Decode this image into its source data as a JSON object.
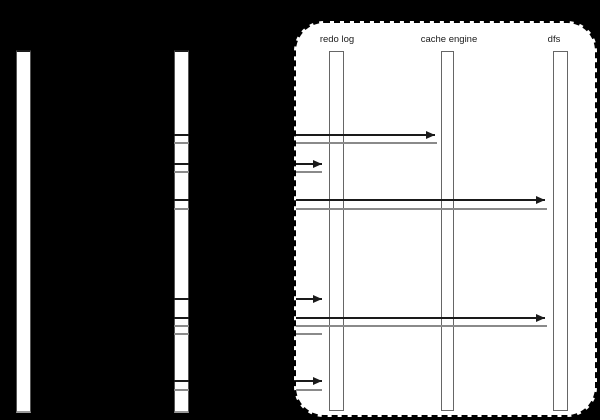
{
  "diagram": {
    "type": "sequence",
    "unlabeled_activation_bars": 2,
    "lifelines": [
      {
        "label": "redo log"
      },
      {
        "label": "cache engine"
      },
      {
        "label": "dfs"
      }
    ],
    "messages": [
      {
        "kind": "call",
        "target": "cache engine",
        "y": 135,
        "x_end": 435
      },
      {
        "kind": "return",
        "y": 143,
        "x_end": 437
      },
      {
        "kind": "call",
        "target": "redo log",
        "y": 164,
        "x_end": 322
      },
      {
        "kind": "return",
        "y": 172,
        "x_end": 322
      },
      {
        "kind": "call",
        "target": "dfs",
        "y": 200,
        "x_end": 545
      },
      {
        "kind": "return",
        "y": 209,
        "x_end": 547
      },
      {
        "kind": "call",
        "target": "redo log",
        "y": 299,
        "x_end": 322
      },
      {
        "kind": "call",
        "target": "dfs",
        "y": 318,
        "x_end": 545
      },
      {
        "kind": "return",
        "y": 326,
        "x_end": 547
      },
      {
        "kind": "return",
        "y": 334,
        "x_end": 322
      },
      {
        "kind": "call",
        "target": "redo log",
        "y": 381,
        "x_end": 322
      },
      {
        "kind": "return",
        "y": 390,
        "x_end": 322
      }
    ],
    "colors": {
      "background": "#000000",
      "call_line": "#1a1a1a",
      "return_line": "#8a8a8a",
      "bar_fill": "#ffffff",
      "bar_border": "#666666",
      "frame_fill": "#ffffff",
      "frame_border": "#000000",
      "label_text": "#1a1a1a"
    }
  }
}
